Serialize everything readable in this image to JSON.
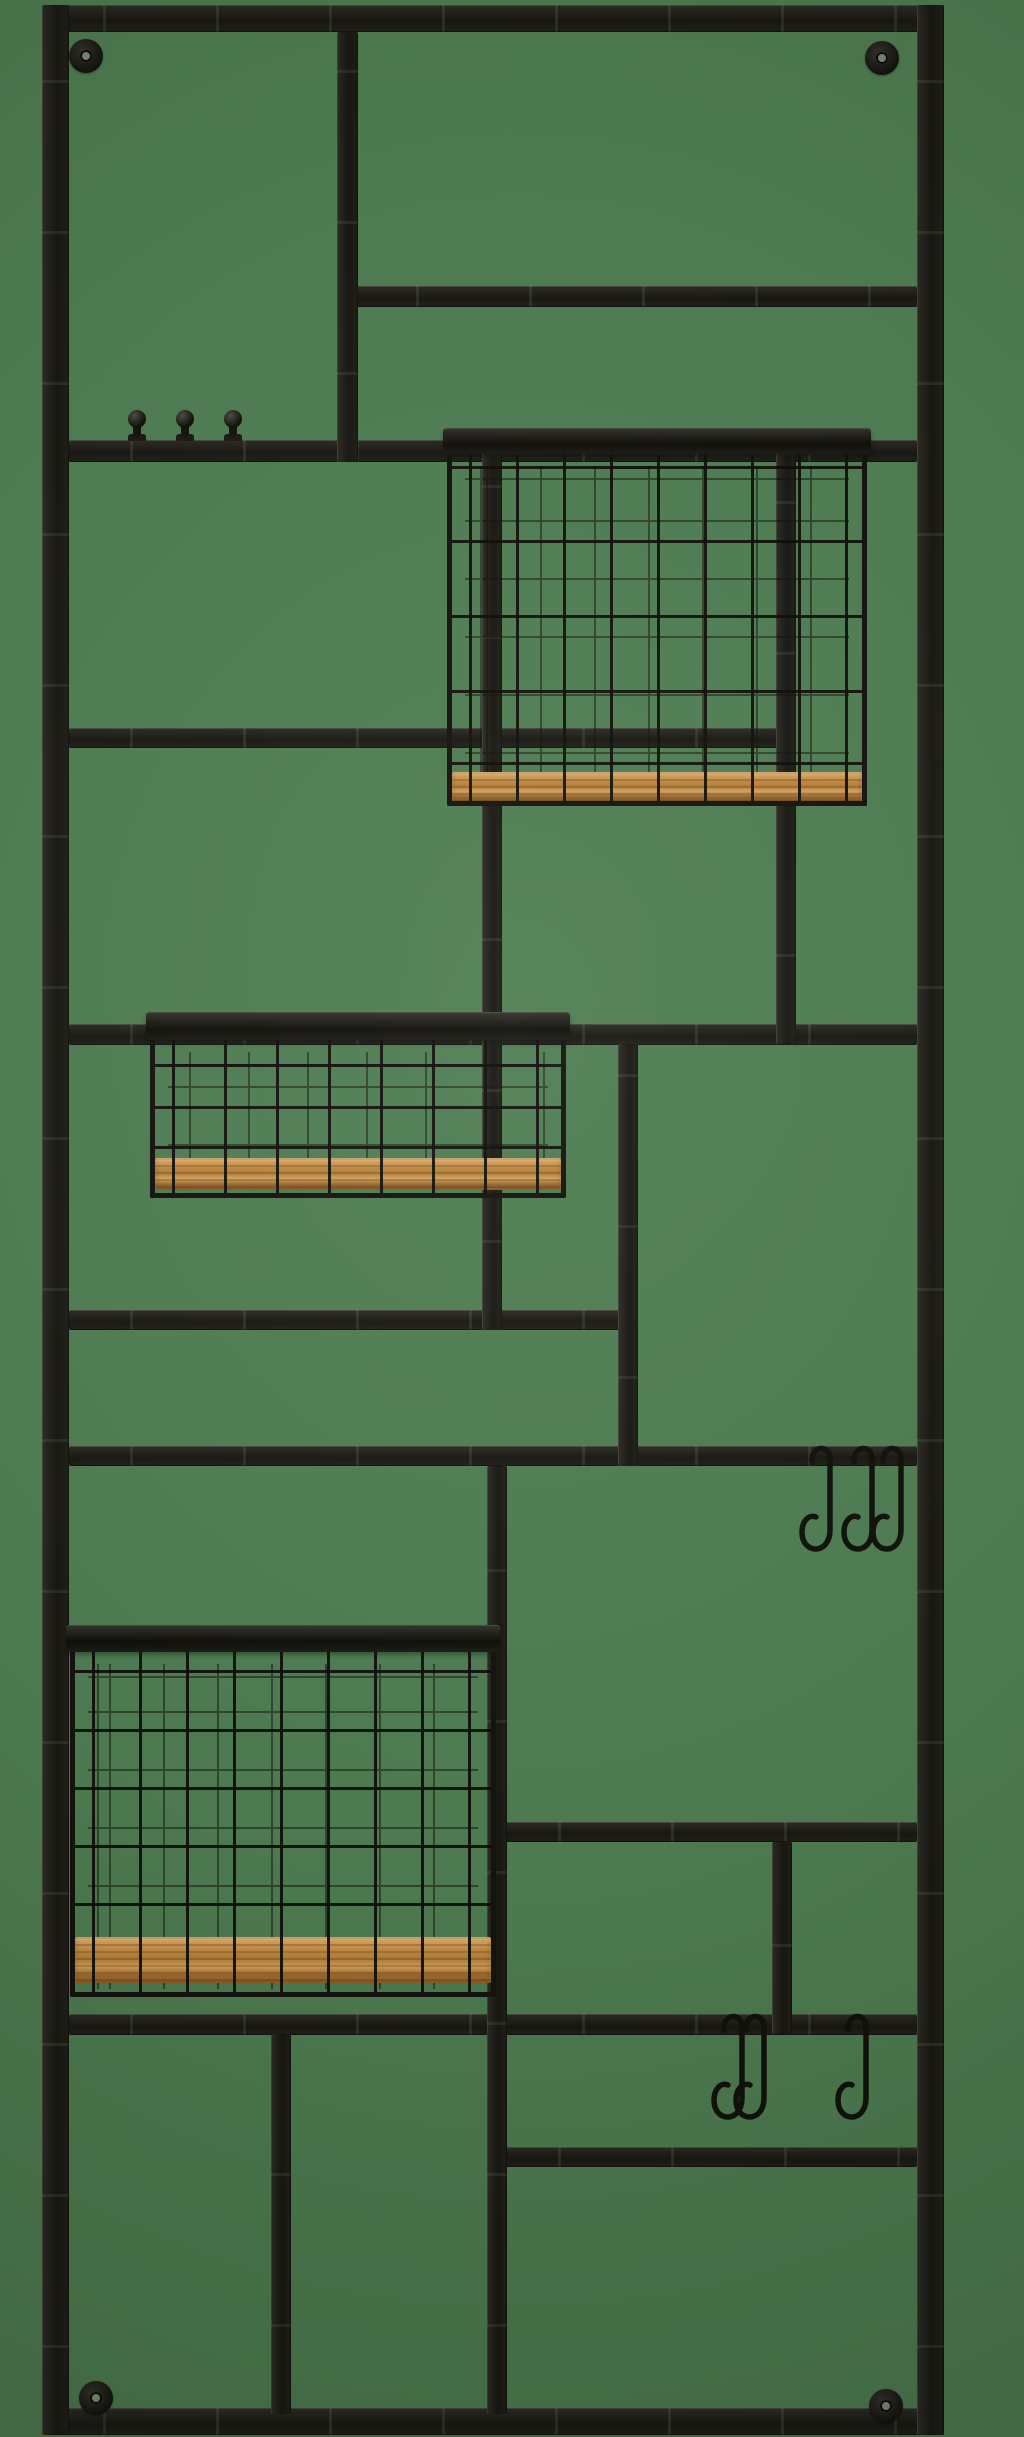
{
  "scene": {
    "type": "product-photo",
    "subject": "black metal wall-mounted grid storage rack with three wire baskets with wooden bases, three peg knobs, six S-hooks and four corner screw brackets",
    "background_color": "#4d7a50",
    "metal_color": "#1e1d17",
    "wire_color": "#12120c",
    "wood_color": "#bd8743",
    "wood_light": "#dcab66",
    "wood_dark": "#8e5e2a",
    "screw_hole_color": "#75876f",
    "basket_count": 3,
    "s_hook_count": 6,
    "peg_knob_count": 3,
    "bracket_count": 4
  },
  "canvas": {
    "width": 1024,
    "height": 2437
  },
  "frame": {
    "x": 42,
    "y": 5,
    "width": 902,
    "height": 2430,
    "thickness": 27
  },
  "horizontal_bars": [
    {
      "name": "divider-h1",
      "x": 355,
      "y": 286,
      "w": 562,
      "h": 21
    },
    {
      "name": "divider-h2",
      "x": 69,
      "y": 440,
      "w": 848,
      "h": 22
    },
    {
      "name": "divider-h3",
      "x": 69,
      "y": 728,
      "w": 717,
      "h": 20
    },
    {
      "name": "divider-h4",
      "x": 69,
      "y": 1024,
      "w": 848,
      "h": 21
    },
    {
      "name": "divider-h5",
      "x": 69,
      "y": 1310,
      "w": 567,
      "h": 20
    },
    {
      "name": "divider-h6",
      "x": 69,
      "y": 1446,
      "w": 848,
      "h": 20
    },
    {
      "name": "divider-h7",
      "x": 497,
      "y": 1822,
      "w": 420,
      "h": 20
    },
    {
      "name": "divider-h8",
      "x": 69,
      "y": 2014,
      "w": 848,
      "h": 21
    },
    {
      "name": "divider-h9",
      "x": 497,
      "y": 2147,
      "w": 420,
      "h": 20
    }
  ],
  "vertical_bars": [
    {
      "name": "divider-v1",
      "x": 337,
      "y": 32,
      "w": 21,
      "h": 430
    },
    {
      "name": "divider-v2",
      "x": 482,
      "y": 450,
      "w": 20,
      "h": 880
    },
    {
      "name": "divider-v3",
      "x": 776,
      "y": 450,
      "w": 20,
      "h": 594
    },
    {
      "name": "divider-v4",
      "x": 618,
      "y": 1044,
      "w": 20,
      "h": 422
    },
    {
      "name": "divider-v5",
      "x": 487,
      "y": 1466,
      "w": 20,
      "h": 948
    },
    {
      "name": "divider-v6",
      "x": 772,
      "y": 1842,
      "w": 20,
      "h": 192
    },
    {
      "name": "divider-v7",
      "x": 271,
      "y": 2034,
      "w": 20,
      "h": 380
    }
  ],
  "baskets": [
    {
      "name": "wire-basket-top",
      "x": 447,
      "y": 428,
      "w": 420,
      "h": 378,
      "rim_h": 26,
      "wire_gap": 47,
      "rows": [
        38,
        112,
        187,
        262,
        334
      ],
      "wood_top": 344,
      "wood_h": 30
    },
    {
      "name": "wire-basket-middle",
      "x": 150,
      "y": 1012,
      "w": 416,
      "h": 186,
      "rim_h": 28,
      "wire_gap": 52,
      "rows": [
        52,
        94,
        134
      ],
      "wood_top": 146,
      "wood_h": 32
    },
    {
      "name": "wire-basket-bottom",
      "x": 70,
      "y": 1625,
      "w": 426,
      "h": 372,
      "rim_h": 27,
      "wire_gap": 47,
      "rows": [
        45,
        104,
        162,
        220,
        278
      ],
      "wood_top": 312,
      "wood_h": 46
    }
  ],
  "peg_knobs": {
    "ball_radius": 9,
    "items": [
      {
        "cx": 137,
        "cy": 419
      },
      {
        "cx": 185,
        "cy": 419
      },
      {
        "cx": 233,
        "cy": 419
      }
    ]
  },
  "s_hooks": [
    {
      "x": 830,
      "bar_y": 1446
    },
    {
      "x": 872,
      "bar_y": 1446
    },
    {
      "x": 901,
      "bar_y": 1446
    },
    {
      "x": 742,
      "bar_y": 2014
    },
    {
      "x": 764,
      "bar_y": 2014
    },
    {
      "x": 866,
      "bar_y": 2014
    }
  ],
  "wall_brackets": [
    {
      "cx": 86,
      "cy": 56
    },
    {
      "cx": 882,
      "cy": 58
    },
    {
      "cx": 96,
      "cy": 2398
    },
    {
      "cx": 886,
      "cy": 2406
    }
  ]
}
